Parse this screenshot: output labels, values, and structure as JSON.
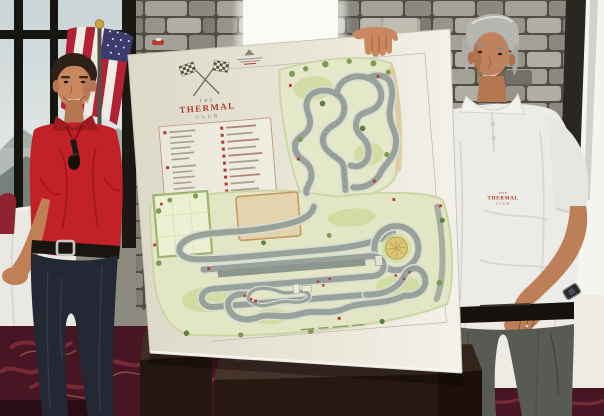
{
  "poster": {
    "logo": {
      "word_top": "THE",
      "word_main": "THERMAL",
      "word_bottom": "CLUB"
    },
    "legend": {
      "legible": false,
      "left_column_rows": 13,
      "right_column_rows": 10
    },
    "colors": {
      "board": "#e9e6d8",
      "map_base_green": "#e2e6c4",
      "track_gray": "#9aa29c",
      "marker_red": "#b03a2e",
      "desert_tan": "#e3d4ad",
      "center_circle_yellow": "#d9c775"
    }
  },
  "left_man": {
    "shirt_color": "#c22127",
    "trousers_color": "#232834"
  },
  "right_man": {
    "shirt_color": "#ebebe7",
    "trousers_color": "#575b53",
    "shirt_logo": {
      "word_top": "THE",
      "word_main": "THERMAL",
      "word_bottom": "CLUB"
    }
  },
  "flag_colors": {
    "red": "#b22234",
    "white": "#efece4",
    "blue": "#3c3b6e"
  }
}
